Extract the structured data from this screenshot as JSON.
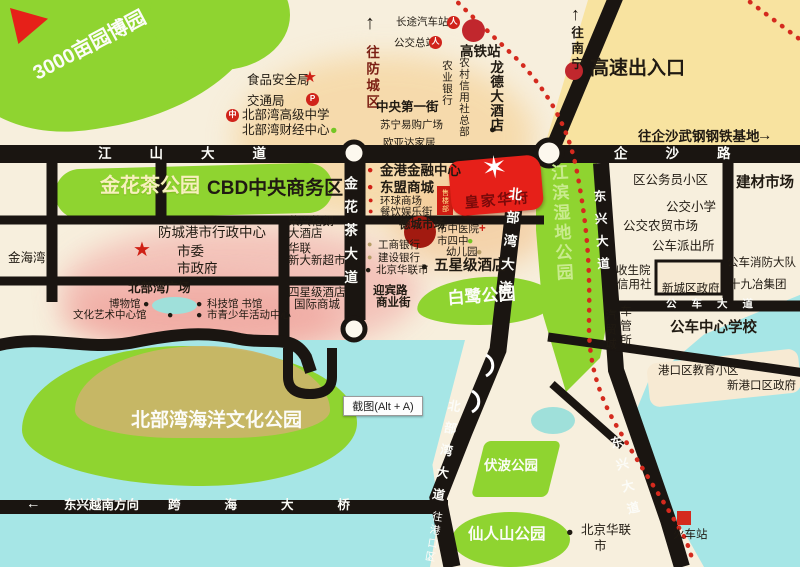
{
  "colors": {
    "park": "#8fd430",
    "road": "#1a1511",
    "sea": "#a6e6e6",
    "red": "#e62019",
    "rail": "#d42a1e",
    "cream": "#f7efdd",
    "yellow": "#f8e3a0",
    "peach": "#f6d49c",
    "pink": "#f3bcb4",
    "khaki": "#c9b568"
  },
  "banner": {
    "star_icon": "✶",
    "name": "皇家华府"
  },
  "sales_office": {
    "label": "售楼部"
  },
  "tooltip": {
    "text": "截图(Alt + A)"
  },
  "labels": [
    {
      "n": "park-3000mu-label",
      "t": "3000亩园博园",
      "x": 30,
      "y": 66,
      "c": "s20 b w r-28"
    },
    {
      "n": "road-jiangshan-label",
      "t": "江山大道",
      "x": 98,
      "y": 147,
      "c": "s13 b w ls-lg"
    },
    {
      "n": "road-qisha-label",
      "t": "企沙路",
      "x": 614,
      "y": 147,
      "c": "s13 b w ls-lg"
    },
    {
      "n": "food-safety-bureau",
      "t": "食品安全局",
      "x": 247,
      "y": 74,
      "c": "s12"
    },
    {
      "n": "food-safety-star-icon",
      "t": "★",
      "x": 303,
      "y": 70,
      "c": "s15 redc"
    },
    {
      "n": "transport-bureau",
      "t": "交通局",
      "x": 247,
      "y": 95,
      "c": "s12"
    },
    {
      "n": "parking-icon",
      "t": "P",
      "x": 306,
      "y": 93,
      "c": "ic-circle"
    },
    {
      "n": "school-icon",
      "t": "中",
      "x": 226,
      "y": 109,
      "c": "ic-circle"
    },
    {
      "n": "beibuwan-high-school",
      "t": "北部湾高级中学",
      "x": 242,
      "y": 109,
      "c": "s12"
    },
    {
      "n": "beibuwan-finance-center",
      "t": "北部湾财经中心",
      "x": 242,
      "y": 124,
      "c": "s12"
    },
    {
      "n": "finance-center-dot-icon",
      "t": "●",
      "x": 330,
      "y": 124,
      "c": "s12 grn-dot"
    },
    {
      "n": "to-fangcheng-arrow-icon",
      "t": "↑",
      "x": 365,
      "y": 13,
      "c": "s20 b"
    },
    {
      "n": "to-fangcheng-district",
      "t": "往防城区",
      "x": 364,
      "y": 45,
      "c": "v s13 b dkred"
    },
    {
      "n": "long-distance-bus-station",
      "t": "长途汽车站",
      "x": 396,
      "y": 17,
      "c": "s10"
    },
    {
      "n": "bus-station-icon",
      "t": "人",
      "x": 447,
      "y": 16,
      "c": "ic-circle"
    },
    {
      "n": "bus-terminal",
      "t": "公交总站",
      "x": 394,
      "y": 38,
      "c": "s10"
    },
    {
      "n": "bus-terminal-icon",
      "t": "人",
      "x": 429,
      "y": 36,
      "c": "ic-circle"
    },
    {
      "n": "high-speed-rail-station",
      "t": "高铁站",
      "x": 460,
      "y": 45,
      "c": "s13 b"
    },
    {
      "n": "longde-hotel",
      "t": "龙德大酒店",
      "x": 488,
      "y": 60,
      "c": "v s13 b vt"
    },
    {
      "n": "longde-hotel-dot-icon",
      "t": "●",
      "x": 489,
      "y": 124,
      "c": "s11"
    },
    {
      "n": "rural-credit-union-hq",
      "t": "农村信用社总部",
      "x": 458,
      "y": 57,
      "c": "v s10 vt"
    },
    {
      "n": "agricultural-bank",
      "t": "农业银行",
      "x": 441,
      "y": 60,
      "c": "v s10 vt"
    },
    {
      "n": "central-first-street",
      "t": "中央第一街",
      "x": 376,
      "y": 101,
      "c": "s12 b"
    },
    {
      "n": "suning-plaza",
      "t": "苏宁易购广场",
      "x": 380,
      "y": 120,
      "c": "s10"
    },
    {
      "n": "ouyada-home",
      "t": "欧亚达家居",
      "x": 383,
      "y": 138,
      "c": "s10"
    },
    {
      "n": "to-nanning-arrow-icon",
      "t": "↑",
      "x": 571,
      "y": 5,
      "c": "s18 b"
    },
    {
      "n": "to-nanning",
      "t": "往南宁",
      "x": 569,
      "y": 26,
      "c": "v s12 b"
    },
    {
      "n": "expressway-exit",
      "t": "高速出入口",
      "x": 590,
      "y": 59,
      "c": "s19 b"
    },
    {
      "n": "to-qisha-steel-base",
      "t": "往企沙武钢钢铁基地",
      "x": 638,
      "y": 130,
      "c": "s13 b"
    },
    {
      "n": "to-qisha-arrow-icon",
      "t": "→",
      "x": 757,
      "y": 128,
      "c": "s15 b"
    },
    {
      "n": "jinhuacha-park-label",
      "t": "金花茶公园",
      "x": 100,
      "y": 176,
      "c": "s20 b cream"
    },
    {
      "n": "cbd-label",
      "t": "CBD中央商务区",
      "x": 207,
      "y": 179,
      "c": "s19 b"
    },
    {
      "n": "jingang-finance-center",
      "t": "金港金融中心",
      "x": 380,
      "y": 164,
      "c": "s13 b"
    },
    {
      "n": "jingang-bullet-icon",
      "t": "●",
      "x": 367,
      "y": 165,
      "c": "s10 redc"
    },
    {
      "n": "asean-mall",
      "t": "东盟商城",
      "x": 380,
      "y": 181,
      "c": "s13 b"
    },
    {
      "n": "asean-bullet-icon",
      "t": "●",
      "x": 367,
      "y": 182,
      "c": "s10 redc"
    },
    {
      "n": "global-mall",
      "t": "环球商场",
      "x": 380,
      "y": 196,
      "c": "s10"
    },
    {
      "n": "global-bullet-icon",
      "t": "●",
      "x": 368,
      "y": 196,
      "c": "s9 redc"
    },
    {
      "n": "food-street",
      "t": "餐饮娱乐街",
      "x": 380,
      "y": 207,
      "c": "s10"
    },
    {
      "n": "food-street-bullet-icon",
      "t": "●",
      "x": 368,
      "y": 207,
      "c": "s9 redc"
    },
    {
      "n": "decheng-market",
      "t": "德城市场",
      "x": 399,
      "y": 219,
      "c": "s11 b"
    },
    {
      "n": "city-tcm-hospital",
      "t": "市中医院",
      "x": 437,
      "y": 224,
      "c": "s10"
    },
    {
      "n": "hospital-cross-icon",
      "t": "+",
      "x": 479,
      "y": 223,
      "c": "s11 redc b"
    },
    {
      "n": "city-no4-middle-school",
      "t": "市四中",
      "x": 437,
      "y": 236,
      "c": "s10"
    },
    {
      "n": "school4-dot-icon",
      "t": "●",
      "x": 467,
      "y": 236,
      "c": "s10 grn-dot"
    },
    {
      "n": "kindergarten",
      "t": "幼儿园",
      "x": 446,
      "y": 247,
      "c": "s10"
    },
    {
      "n": "kindergarten-dot-icon",
      "t": "●",
      "x": 476,
      "y": 247,
      "c": "s10 tan-dot"
    },
    {
      "n": "icbc-bank",
      "t": "工商银行",
      "x": 378,
      "y": 240,
      "c": "s10"
    },
    {
      "n": "icbc-dot-icon",
      "t": "●",
      "x": 367,
      "y": 240,
      "c": "s9 tan-dot"
    },
    {
      "n": "ccb-bank",
      "t": "建设银行",
      "x": 378,
      "y": 253,
      "c": "s10"
    },
    {
      "n": "ccb-dot-icon",
      "t": "●",
      "x": 367,
      "y": 253,
      "c": "s9 tan-dot"
    },
    {
      "n": "beijing-hualian",
      "t": "北京华联市",
      "x": 376,
      "y": 265,
      "c": "s10"
    },
    {
      "n": "hualian-dot-icon",
      "t": "●",
      "x": 365,
      "y": 265,
      "c": "s10"
    },
    {
      "n": "five-star-hotel",
      "t": "五星级酒店",
      "x": 434,
      "y": 259,
      "c": "s14 b"
    },
    {
      "n": "five-star-dot-icon",
      "t": "●",
      "x": 421,
      "y": 261,
      "c": "s11"
    },
    {
      "n": "road-jinhuacha-label",
      "t": "金花茶大道",
      "x": 342,
      "y": 176,
      "c": "v s13 b w vsp"
    },
    {
      "n": "road-beibuwan-upper-label",
      "t": "北部湾大道",
      "x": 507,
      "y": 186,
      "c": "v s13 b w vsp r6"
    },
    {
      "n": "wetland-park-label",
      "t": "江滨湿地公园",
      "x": 548,
      "y": 164,
      "c": "v s17 b wet r-3"
    },
    {
      "n": "road-dongxing-upper-label",
      "t": "东兴大道",
      "x": 591,
      "y": 190,
      "c": "v s12 b w vsp r-3"
    },
    {
      "n": "city-admin-center",
      "t": "防城港市行政中心",
      "x": 158,
      "y": 226,
      "c": "s13"
    },
    {
      "n": "city-committee",
      "t": "市委",
      "x": 177,
      "y": 245,
      "c": "s13"
    },
    {
      "n": "city-government",
      "t": "市政府",
      "x": 177,
      "y": 262,
      "c": "s13"
    },
    {
      "n": "government-star-icon",
      "t": "★",
      "x": 133,
      "y": 240,
      "c": "s20 redc"
    },
    {
      "n": "jinhaiwan",
      "t": "金海湾",
      "x": 8,
      "y": 252,
      "c": "s12"
    },
    {
      "n": "rongxing-hotel-line1",
      "t": "荣兴格朗",
      "x": 288,
      "y": 216,
      "c": "s11"
    },
    {
      "n": "rongxing-hotel-line2",
      "t": "大酒店",
      "x": 288,
      "y": 228,
      "c": "s11"
    },
    {
      "n": "hualian-store",
      "t": "华联",
      "x": 288,
      "y": 243,
      "c": "s11"
    },
    {
      "n": "xindaxin-supermarket",
      "t": "新大新超市",
      "x": 288,
      "y": 255,
      "c": "s11"
    },
    {
      "n": "beibuwan-square",
      "t": "北部湾广场",
      "x": 128,
      "y": 282,
      "c": "s12 b"
    },
    {
      "n": "museum",
      "t": "博物馆",
      "x": 109,
      "y": 299,
      "c": "s10"
    },
    {
      "n": "museum-dot-icon",
      "t": "●",
      "x": 143,
      "y": 299,
      "c": "s10"
    },
    {
      "n": "science-museum",
      "t": "科技馆 书馆",
      "x": 207,
      "y": 299,
      "c": "s10"
    },
    {
      "n": "science-dot-icon",
      "t": "●",
      "x": 196,
      "y": 299,
      "c": "s10"
    },
    {
      "n": "culture-art-center",
      "t": "文化艺术中心馆",
      "x": 73,
      "y": 310,
      "c": "s10"
    },
    {
      "n": "culture-dot-icon",
      "t": "●",
      "x": 167,
      "y": 310,
      "c": "s10"
    },
    {
      "n": "youth-activity-center",
      "t": "市青少年活动中心",
      "x": 207,
      "y": 310,
      "c": "s10"
    },
    {
      "n": "youth-dot-icon",
      "t": "●",
      "x": 196,
      "y": 310,
      "c": "s10"
    },
    {
      "n": "four-star-hotel",
      "t": "四星级酒店",
      "x": 288,
      "y": 287,
      "c": "s11"
    },
    {
      "n": "intl-mall",
      "t": "国际商城",
      "x": 294,
      "y": 299,
      "c": "s11"
    },
    {
      "n": "yingbin-road",
      "t": "迎宾路",
      "x": 373,
      "y": 285,
      "c": "s11 b"
    },
    {
      "n": "commercial-street",
      "t": "商业街",
      "x": 376,
      "y": 297,
      "c": "s11 b"
    },
    {
      "n": "egret-park-label",
      "t": "白鹭公园",
      "x": 447,
      "y": 290,
      "c": "s17 b w r-4"
    },
    {
      "n": "civil-servant-community",
      "t": "区公务员小区",
      "x": 633,
      "y": 174,
      "c": "s12"
    },
    {
      "n": "gongjiao-primary-school",
      "t": "公交小学",
      "x": 666,
      "y": 201,
      "c": "s12"
    },
    {
      "n": "gongjiao-farmers-market",
      "t": "公交农贸市场",
      "x": 623,
      "y": 220,
      "c": "s12"
    },
    {
      "n": "gongche-police-station",
      "t": "公车派出所",
      "x": 652,
      "y": 240,
      "c": "s12"
    },
    {
      "n": "building-materials-market",
      "t": "建材市场",
      "x": 736,
      "y": 176,
      "c": "s14 b"
    },
    {
      "n": "fire-brigade",
      "t": "公车消防大队",
      "x": 727,
      "y": 257,
      "c": "s11"
    },
    {
      "n": "shijiuye-group",
      "t": "十九冶集团",
      "x": 729,
      "y": 279,
      "c": "s11"
    },
    {
      "n": "health-center",
      "t": "收生院",
      "x": 616,
      "y": 265,
      "c": "s11"
    },
    {
      "n": "credit-union",
      "t": "信用社",
      "x": 617,
      "y": 279,
      "c": "s11"
    },
    {
      "n": "new-district-government",
      "t": "新城区政府",
      "x": 662,
      "y": 283,
      "c": "s11"
    },
    {
      "n": "road-gongche-label",
      "t": "公车大道",
      "x": 666,
      "y": 299,
      "c": "s10 b w ls-sm"
    },
    {
      "n": "auto-trade-city",
      "t": "汽贸城",
      "x": 604,
      "y": 309,
      "c": "v s11"
    },
    {
      "n": "vehicle-admin-office",
      "t": "车管所",
      "x": 619,
      "y": 305,
      "c": "v s11"
    },
    {
      "n": "gongche-central-school",
      "t": "公车中心学校",
      "x": 670,
      "y": 321,
      "c": "s14 b"
    },
    {
      "n": "gangkou-education-community",
      "t": "港口区教育小区",
      "x": 658,
      "y": 365,
      "c": "s11"
    },
    {
      "n": "new-gangkou-government",
      "t": "新港口区政府",
      "x": 727,
      "y": 380,
      "c": "s11"
    },
    {
      "n": "ocean-culture-park-label",
      "t": "北部湾海洋文化公园",
      "x": 131,
      "y": 411,
      "c": "s19 b w"
    },
    {
      "n": "bridge-arrow-icon",
      "t": "←",
      "x": 26,
      "y": 497,
      "c": "s14 b w"
    },
    {
      "n": "dongxing-vietnam-direction",
      "t": "东兴越南方向",
      "x": 64,
      "y": 499,
      "c": "s12 b w"
    },
    {
      "n": "cross-sea-bridge-label",
      "t": "跨海大桥",
      "x": 168,
      "y": 499,
      "c": "s12 b w ls-xl"
    },
    {
      "n": "road-beibuwan-lower-label",
      "t": "北部湾大道",
      "x": 447,
      "y": 398,
      "c": "v s12 b w vsp r10"
    },
    {
      "n": "to-gangkou-district",
      "t": "往港口区",
      "x": 432,
      "y": 510,
      "c": "v s10 w r10"
    },
    {
      "n": "to-gangkou-arrow-icon",
      "t": "↓",
      "x": 426,
      "y": 549,
      "c": "s13 b w"
    },
    {
      "n": "road-dongxing-lower-label",
      "t": "东兴大道",
      "x": 607,
      "y": 438,
      "c": "v s12 b w vsp r-14"
    },
    {
      "n": "fubo-park-label",
      "t": "伏波公园",
      "x": 484,
      "y": 459,
      "c": "s13 b w"
    },
    {
      "n": "xianrenshan-park-label",
      "t": "仙人山公园",
      "x": 468,
      "y": 527,
      "c": "s15 b w"
    },
    {
      "n": "beijing-hualian-south",
      "t": "北京华联",
      "x": 581,
      "y": 524,
      "c": "s12"
    },
    {
      "n": "beijing-hualian-south-2",
      "t": "市",
      "x": 594,
      "y": 540,
      "c": "s12"
    },
    {
      "n": "hualian-south-dot-icon",
      "t": "●",
      "x": 566,
      "y": 526,
      "c": "s12"
    },
    {
      "n": "train-station",
      "t": "火车站",
      "x": 673,
      "y": 529,
      "c": "s11"
    }
  ]
}
